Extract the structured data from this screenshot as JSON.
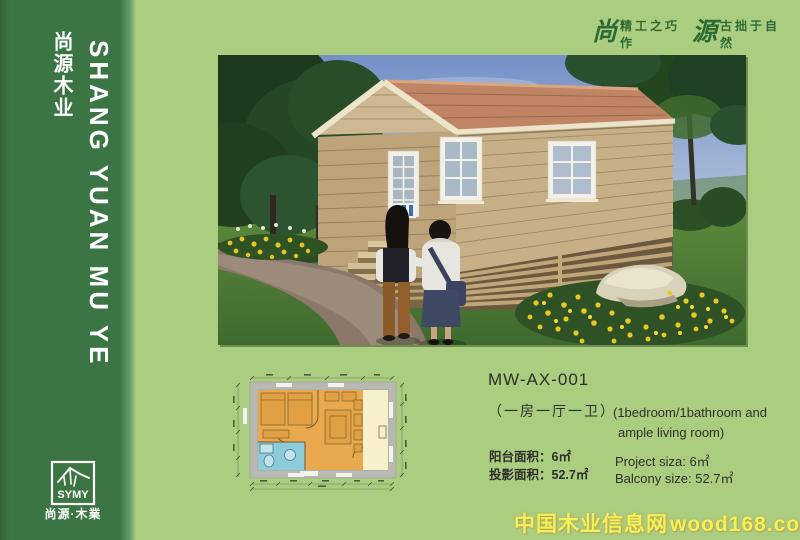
{
  "colors": {
    "page_bg": "#aacd80",
    "sidebar_green": "#3c7544",
    "slogan_green": "#2d6a33",
    "footer_yellow": "#ecf45e",
    "footer_glow": "#e07814",
    "plan_floor_orange": "#e9a94e",
    "plan_bath_blue": "#8ccbd9",
    "plan_balcony_cream": "#f6f1cb",
    "roof_terracotta": "#bf8565",
    "cabin_wood_tan": "#c7b088"
  },
  "sidebar": {
    "brand_cn": "尚源木业",
    "brand_en": "SHANG YUAN MU YE",
    "logo_acronym": "SYMY",
    "logo_caption": "尚源·木業"
  },
  "header": {
    "slogan_big_1": "尚",
    "slogan_small_1": "精工之巧作",
    "slogan_big_2": "源",
    "slogan_small_2": "古拙于自然"
  },
  "product": {
    "model": "MW-AX-001",
    "type_cn": "（一房一厅一卫）",
    "type_en_line1": "(1bedroom/1bathroom and",
    "type_en_line2": "ample living room)",
    "area_cn_1_label": "阳台面积：",
    "area_cn_1_value": "6㎡",
    "area_cn_2_label": "投影面积：",
    "area_cn_2_value": "52.7㎡",
    "area_en_1_label": "Project siza:",
    "area_en_1_value": "6㎡",
    "area_en_2_label": "Balcony size:",
    "area_en_2_value": "52.7㎡"
  },
  "footer": {
    "site_name": "中国木业信息网",
    "site_url": "wood168.com"
  }
}
